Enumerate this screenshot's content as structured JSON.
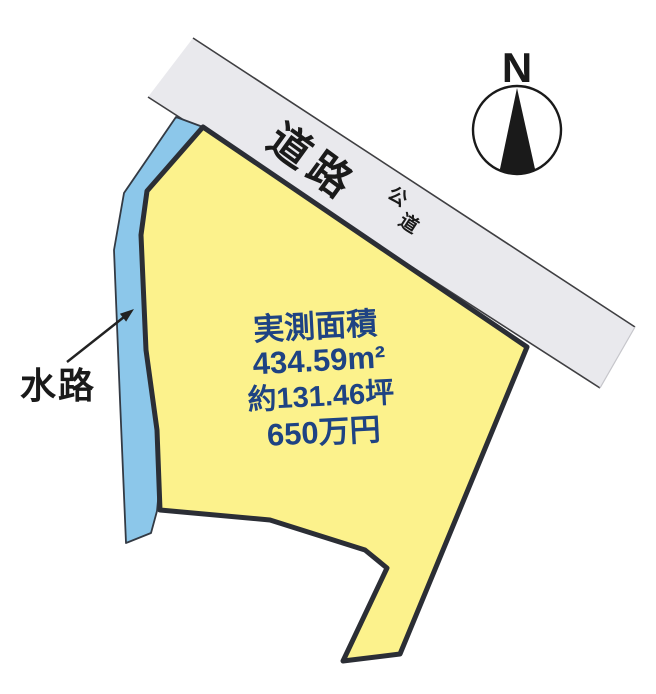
{
  "compass": {
    "north": "N"
  },
  "road": {
    "name": "道路",
    "type_chars": [
      "公",
      "道"
    ]
  },
  "waterway": {
    "name": "水路"
  },
  "parcel": {
    "area_title": "実測面積",
    "area_m2": "434.59m²",
    "area_tsubo": "約131.46坪",
    "price": "650万円"
  },
  "colors": {
    "parcel_fill": "#fcf28c",
    "water_fill": "#8cc7ea",
    "road_fill": "#e9e9ed",
    "outline": "#2b2e35",
    "info_text": "#1e4383",
    "ink": "#1a1a1a"
  }
}
